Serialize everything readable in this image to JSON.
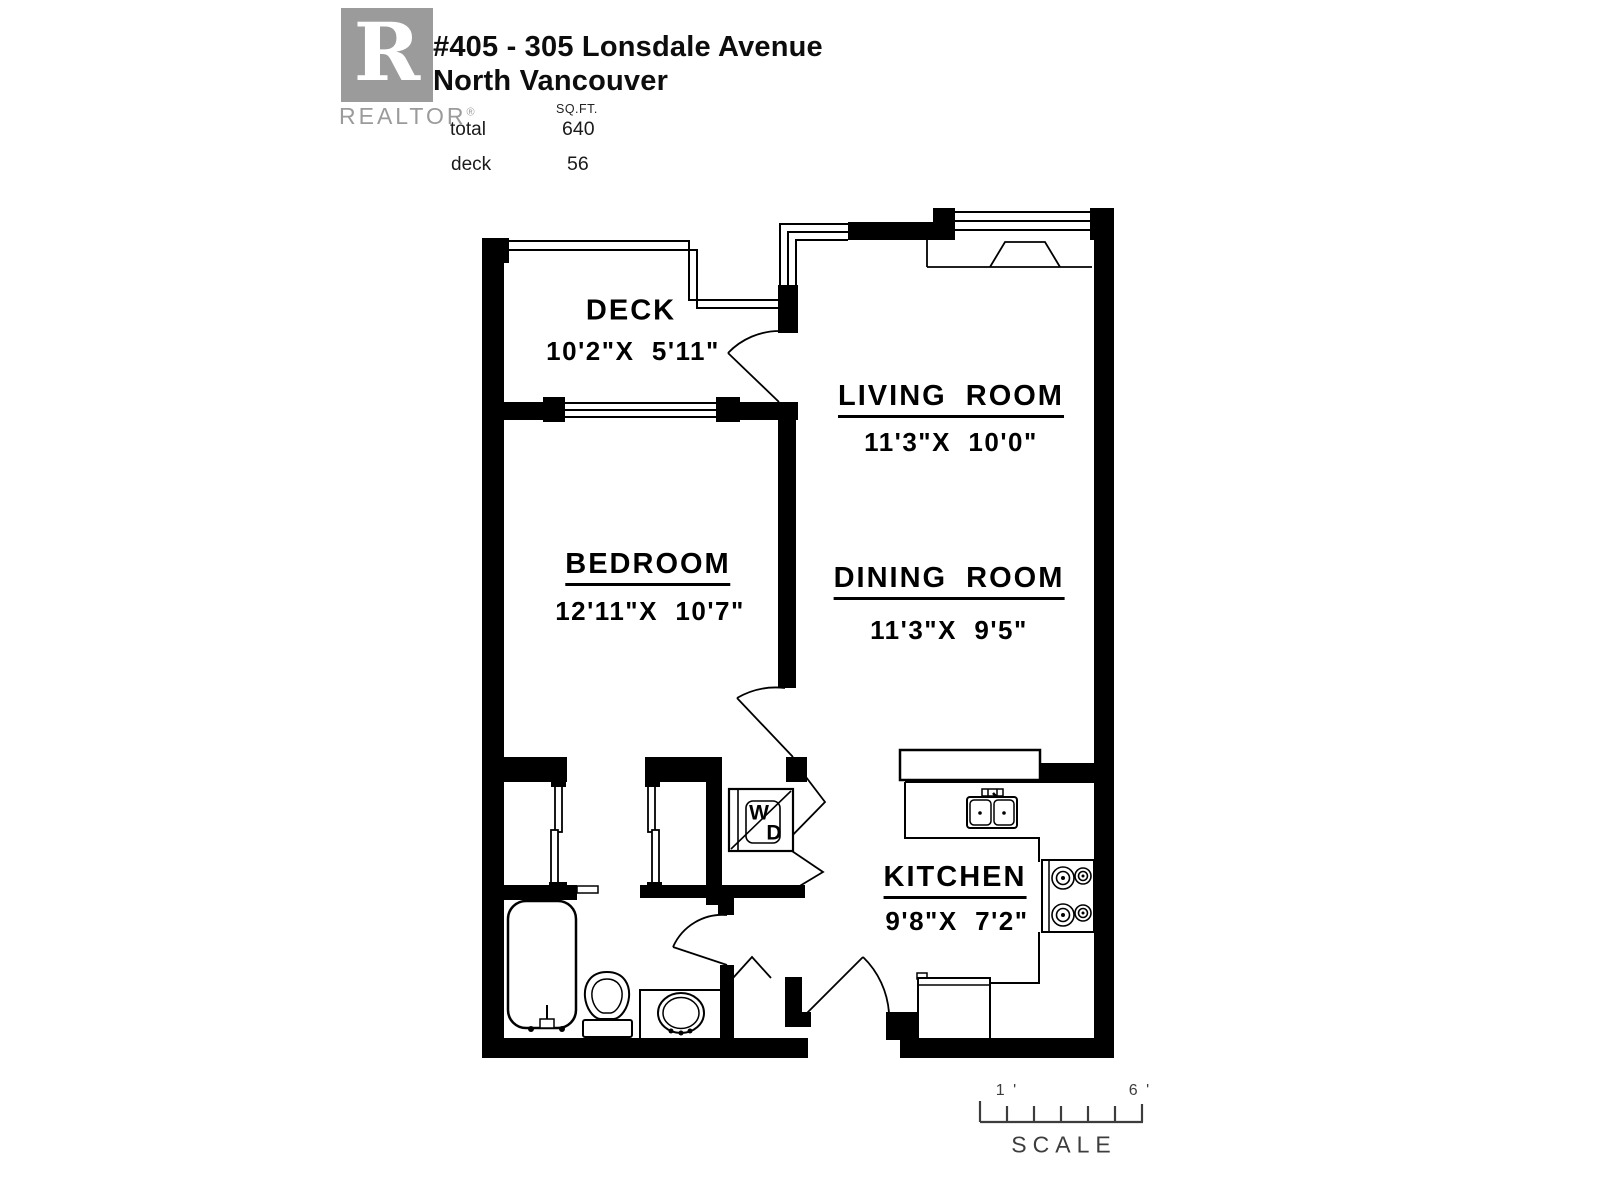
{
  "header": {
    "logo": {
      "letter": "R",
      "wordmark": "REALTOR",
      "registered": "®"
    },
    "address_line1": "#405 - 305 Lonsdale Avenue",
    "address_line2": "North Vancouver",
    "area_table": {
      "unit_label": "SQ.FT.",
      "rows": [
        {
          "label": "total",
          "value": "640"
        },
        {
          "label": "deck",
          "value": "56"
        }
      ]
    }
  },
  "rooms": {
    "deck": {
      "name": "DECK",
      "dims": "10'2\"X  5'11\""
    },
    "living": {
      "name": "LIVING ROOM",
      "dims": "11'3\"X  10'0\""
    },
    "bedroom": {
      "name": "BEDROOM",
      "dims": "12'11\"X  10'7\""
    },
    "dining": {
      "name": "DINING ROOM",
      "dims": "11'3\"X  9'5\""
    },
    "kitchen": {
      "name": "KITCHEN",
      "dims": "9'8\"X  7'2\""
    }
  },
  "appliances": {
    "washer": "W",
    "dryer": "D"
  },
  "scale_bar": {
    "tick_start": "1 '",
    "tick_end": "6 '",
    "caption": "SCALE"
  },
  "colors": {
    "ink": "#000000",
    "logo_gray": "#9b9b9b",
    "scale_gray": "#3d3d3d"
  }
}
